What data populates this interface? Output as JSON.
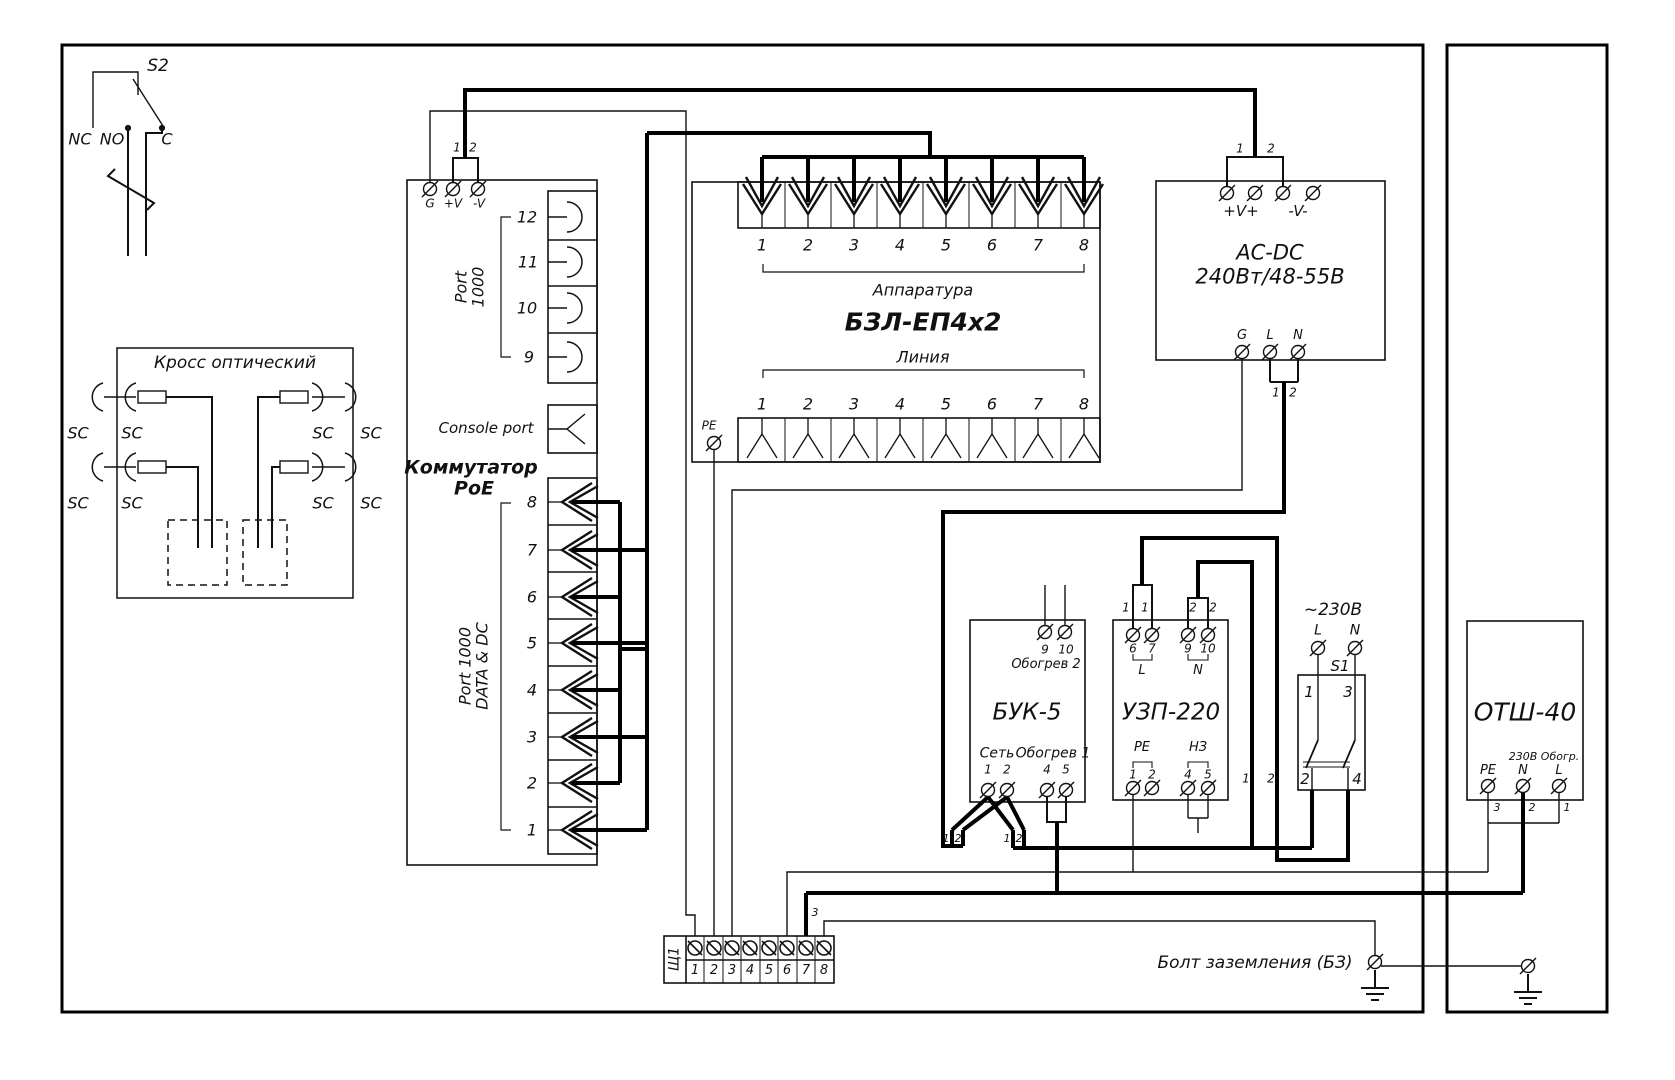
{
  "s2": {
    "label": "S2",
    "nc": "NC",
    "no": "NO",
    "c": "C"
  },
  "optical_cross": {
    "title": "Кросс оптический",
    "sc": "SC"
  },
  "poe_switch": {
    "title1": "Коммутатор",
    "title2": "РоЕ",
    "console": "Console port",
    "port1000_l1": "Port",
    "port1000_l2": "1000",
    "datadc_l1": "Port 1000",
    "datadc_l2": "DATA & DC",
    "g": "G",
    "vplus": "+V",
    "vminus": "-V",
    "w1": "1",
    "w2": "2",
    "top_ports": [
      "12",
      "11",
      "10",
      "9"
    ],
    "bottom_ports": [
      "8",
      "7",
      "6",
      "5",
      "4",
      "3",
      "2",
      "1"
    ]
  },
  "bzl": {
    "title": "БЗЛ-ЕП4х2",
    "apparatus": "Аппаратура",
    "line": "Линия",
    "pe": "PE",
    "apparatus_numbers": [
      "1",
      "2",
      "3",
      "4",
      "5",
      "6",
      "7",
      "8"
    ],
    "line_numbers": [
      "1",
      "2",
      "3",
      "4",
      "5",
      "6",
      "7",
      "8"
    ]
  },
  "acdc": {
    "title1": "AC-DC",
    "title2": "240Вт/48-55В",
    "vplus": "+V+",
    "vminus": "-V-",
    "in1": "1",
    "in2": "2",
    "g": "G",
    "l": "L",
    "n": "N",
    "out1": "1",
    "out2": "2"
  },
  "buk": {
    "title": "БУК-5",
    "heat2": "Обогрев 2",
    "t9": "9",
    "t10": "10",
    "net": "Сеть",
    "t1": "1",
    "t2": "2",
    "heat1": "Обогрев 1",
    "t4": "4",
    "t5": "5",
    "c1a": "1",
    "c1b": "2",
    "c2a": "1",
    "c2b": "2"
  },
  "uzp": {
    "title": "УЗП-220",
    "wa": "1",
    "wb": "1",
    "wc": "2",
    "wd": "2",
    "t6": "6",
    "t7": "7",
    "t9": "9",
    "t10": "10",
    "l": "L",
    "n": "N",
    "pe": "PE",
    "nz": "НЗ",
    "b1": "1",
    "b2": "2",
    "b4": "4",
    "b5": "5"
  },
  "s1": {
    "voltage": "~230В",
    "l": "L",
    "n": "N",
    "title": "S1",
    "c1": "1",
    "c3": "3",
    "c2": "2",
    "c4": "4",
    "w1": "1",
    "w2": "2"
  },
  "otsh": {
    "title": "ОТШ-40",
    "v230": "230В",
    "heat": "Обогр.",
    "pe": "PE",
    "n": "N",
    "l": "L",
    "w3": "3",
    "w2": "2",
    "w1": "1"
  },
  "terminal_block": {
    "label": "Щ1",
    "wire3": "3",
    "numbers": [
      "1",
      "2",
      "3",
      "4",
      "5",
      "6",
      "7",
      "8"
    ]
  },
  "ground": {
    "label": "Болт заземления (БЗ)"
  },
  "colors": {
    "line": "#111111",
    "thick": "#000000"
  }
}
